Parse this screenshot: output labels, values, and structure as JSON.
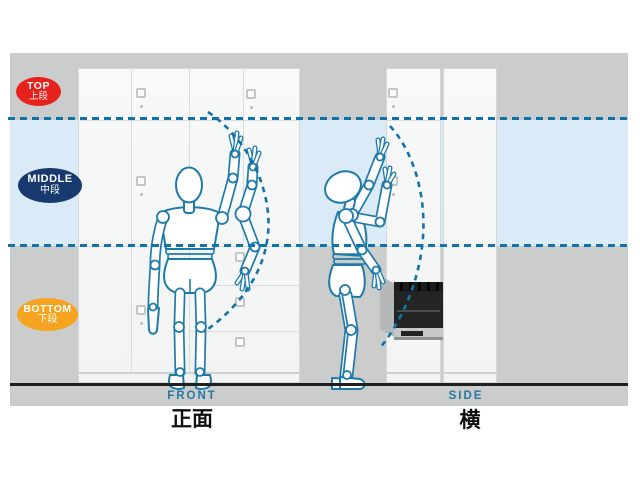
{
  "diagram": {
    "title_hint": "cabinet reach-zone ergonomics diagram",
    "zones": [
      {
        "id": "top",
        "label_en": "TOP",
        "label_ja": "上段",
        "color": "#e7221c"
      },
      {
        "id": "middle",
        "label_en": "MIDDLE",
        "label_ja": "中段",
        "color": "#17396d"
      },
      {
        "id": "bottom",
        "label_en": "BOTTOM",
        "label_ja": "下段",
        "color": "#f6a41f"
      }
    ],
    "views": [
      {
        "id": "front",
        "label_en": "FRONT",
        "label_ja": "正面"
      },
      {
        "id": "side",
        "label_en": "SIDE",
        "label_ja": "横"
      }
    ],
    "colors": {
      "panel_gray": "#cbcccc",
      "reach_band_blue": "#daeaf6",
      "dash_line_blue": "#1173a8",
      "figure_outline_blue": "#1e7ba9",
      "floor_black": "#1e1f1f",
      "cabinet_face": "#f5f6f6",
      "cabinet_line": "#d9dcdd",
      "view_label_blue": "#2a78a2",
      "badge_text": "#ffffff"
    }
  }
}
